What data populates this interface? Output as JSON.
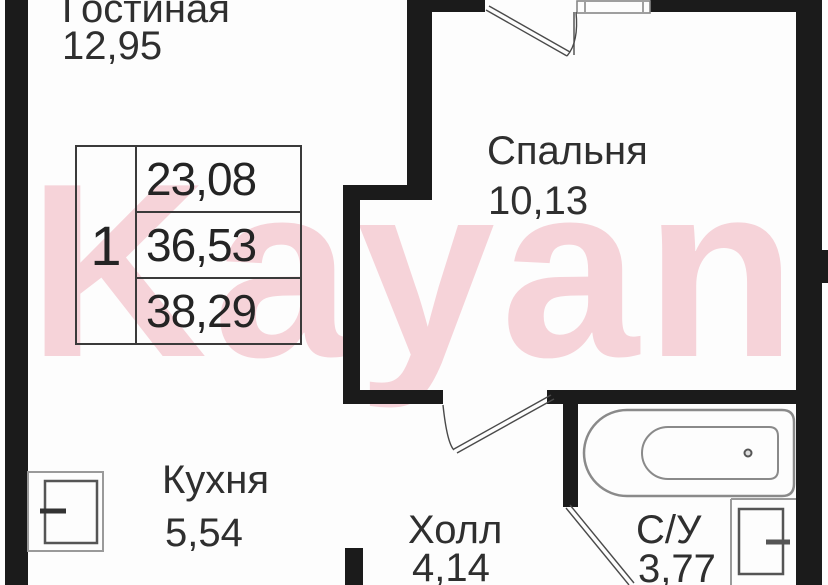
{
  "watermark": {
    "text": "Kayan",
    "color": "#f6d3d9"
  },
  "apartment": {
    "rooms_count": "1",
    "areas": [
      "23,08",
      "36,53",
      "38,29"
    ]
  },
  "rooms": {
    "living": {
      "label": "Гостиная",
      "area": "12,95"
    },
    "bedroom": {
      "label": "Спальня",
      "area": "10,13"
    },
    "kitchen": {
      "label": "Кухня",
      "area": "5,54"
    },
    "hall": {
      "label": "Холл",
      "area": "4,14"
    },
    "bathroom": {
      "label": "С/У",
      "area": "3,77"
    }
  },
  "icons": [
    "bathtub-icon",
    "washing-machine-icon",
    "stove-icon",
    "window-icon",
    "door-swing-icon"
  ],
  "colors": {
    "background": "#fdfdfd",
    "wall": "#1b1b1b",
    "table_border": "#3a3a3a",
    "text": "#2f2f2f",
    "fixture_stroke": "#8a8a8a",
    "door_line": "#4a4a4a",
    "watermark_pink": "#f6d3d9"
  }
}
